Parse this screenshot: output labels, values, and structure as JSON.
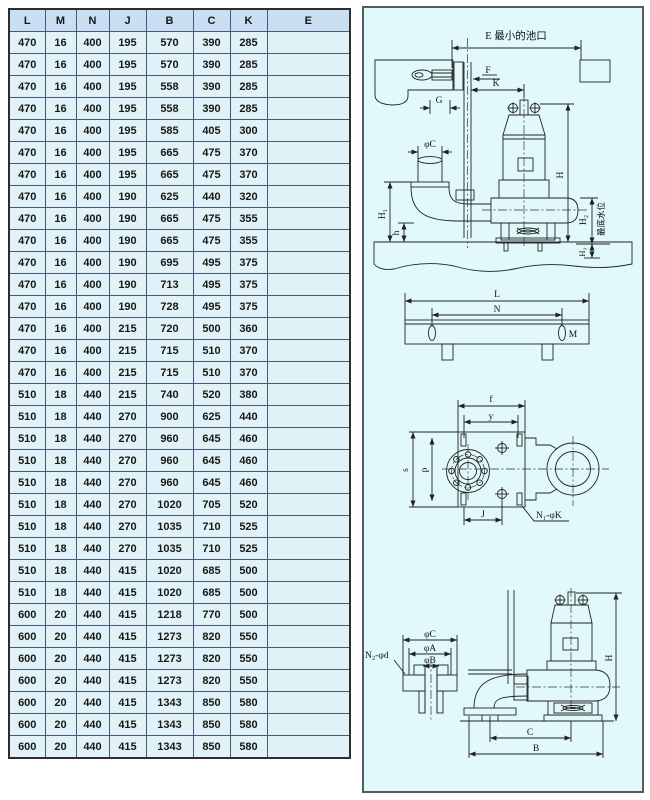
{
  "table": {
    "headers": [
      "L",
      "M",
      "N",
      "J",
      "B",
      "C",
      "K",
      "E"
    ],
    "rows": [
      [
        "470",
        "16",
        "400",
        "195",
        "570",
        "390",
        "285",
        ""
      ],
      [
        "470",
        "16",
        "400",
        "195",
        "570",
        "390",
        "285",
        ""
      ],
      [
        "470",
        "16",
        "400",
        "195",
        "558",
        "390",
        "285",
        ""
      ],
      [
        "470",
        "16",
        "400",
        "195",
        "558",
        "390",
        "285",
        ""
      ],
      [
        "470",
        "16",
        "400",
        "195",
        "585",
        "405",
        "300",
        ""
      ],
      [
        "470",
        "16",
        "400",
        "195",
        "665",
        "475",
        "370",
        ""
      ],
      [
        "470",
        "16",
        "400",
        "195",
        "665",
        "475",
        "370",
        ""
      ],
      [
        "470",
        "16",
        "400",
        "190",
        "625",
        "440",
        "320",
        ""
      ],
      [
        "470",
        "16",
        "400",
        "190",
        "665",
        "475",
        "355",
        ""
      ],
      [
        "470",
        "16",
        "400",
        "190",
        "665",
        "475",
        "355",
        ""
      ],
      [
        "470",
        "16",
        "400",
        "190",
        "695",
        "495",
        "375",
        ""
      ],
      [
        "470",
        "16",
        "400",
        "190",
        "713",
        "495",
        "375",
        ""
      ],
      [
        "470",
        "16",
        "400",
        "190",
        "728",
        "495",
        "375",
        ""
      ],
      [
        "470",
        "16",
        "400",
        "215",
        "720",
        "500",
        "360",
        ""
      ],
      [
        "470",
        "16",
        "400",
        "215",
        "715",
        "510",
        "370",
        ""
      ],
      [
        "470",
        "16",
        "400",
        "215",
        "715",
        "510",
        "370",
        ""
      ],
      [
        "510",
        "18",
        "440",
        "215",
        "740",
        "520",
        "380",
        ""
      ],
      [
        "510",
        "18",
        "440",
        "270",
        "900",
        "625",
        "440",
        ""
      ],
      [
        "510",
        "18",
        "440",
        "270",
        "960",
        "645",
        "460",
        ""
      ],
      [
        "510",
        "18",
        "440",
        "270",
        "960",
        "645",
        "460",
        ""
      ],
      [
        "510",
        "18",
        "440",
        "270",
        "960",
        "645",
        "460",
        ""
      ],
      [
        "510",
        "18",
        "440",
        "270",
        "1020",
        "705",
        "520",
        ""
      ],
      [
        "510",
        "18",
        "440",
        "270",
        "1035",
        "710",
        "525",
        ""
      ],
      [
        "510",
        "18",
        "440",
        "270",
        "1035",
        "710",
        "525",
        ""
      ],
      [
        "510",
        "18",
        "440",
        "415",
        "1020",
        "685",
        "500",
        ""
      ],
      [
        "510",
        "18",
        "440",
        "415",
        "1020",
        "685",
        "500",
        ""
      ],
      [
        "600",
        "20",
        "440",
        "415",
        "1218",
        "770",
        "500",
        ""
      ],
      [
        "600",
        "20",
        "440",
        "415",
        "1273",
        "820",
        "550",
        ""
      ],
      [
        "600",
        "20",
        "440",
        "415",
        "1273",
        "820",
        "550",
        ""
      ],
      [
        "600",
        "20",
        "440",
        "415",
        "1273",
        "820",
        "550",
        ""
      ],
      [
        "600",
        "20",
        "440",
        "415",
        "1343",
        "850",
        "580",
        ""
      ],
      [
        "600",
        "20",
        "440",
        "415",
        "1343",
        "850",
        "580",
        ""
      ],
      [
        "600",
        "20",
        "440",
        "415",
        "1343",
        "850",
        "580",
        ""
      ]
    ]
  },
  "drawings": {
    "install": {
      "e": "E 最小的池口",
      "f": "F",
      "k": "K",
      "g": "G",
      "phi_c": "φC",
      "h1": "H₁",
      "h": "h",
      "H": "H",
      "h2": "H₂",
      "water": "最底水位",
      "h3": "H₃"
    },
    "plate": {
      "l": "L",
      "n": "N",
      "m": "M"
    },
    "plan": {
      "f": "f",
      "y": "y",
      "s": "s",
      "p": "p",
      "j": "J",
      "bolt_note": "N₁-φK"
    },
    "side": {
      "phi_c": "φC",
      "phi_a": "φA",
      "phi_b": "φB",
      "bolt_note": "N₂-φd",
      "H": "H",
      "c": "C",
      "b": "B"
    }
  },
  "colors": {
    "header_bg": "#cbdff2",
    "cell_bg": "#e2f3f8",
    "panel_bg": "#e1f9fa",
    "grid_line": "#47597a",
    "drawing_line": "#222222"
  }
}
